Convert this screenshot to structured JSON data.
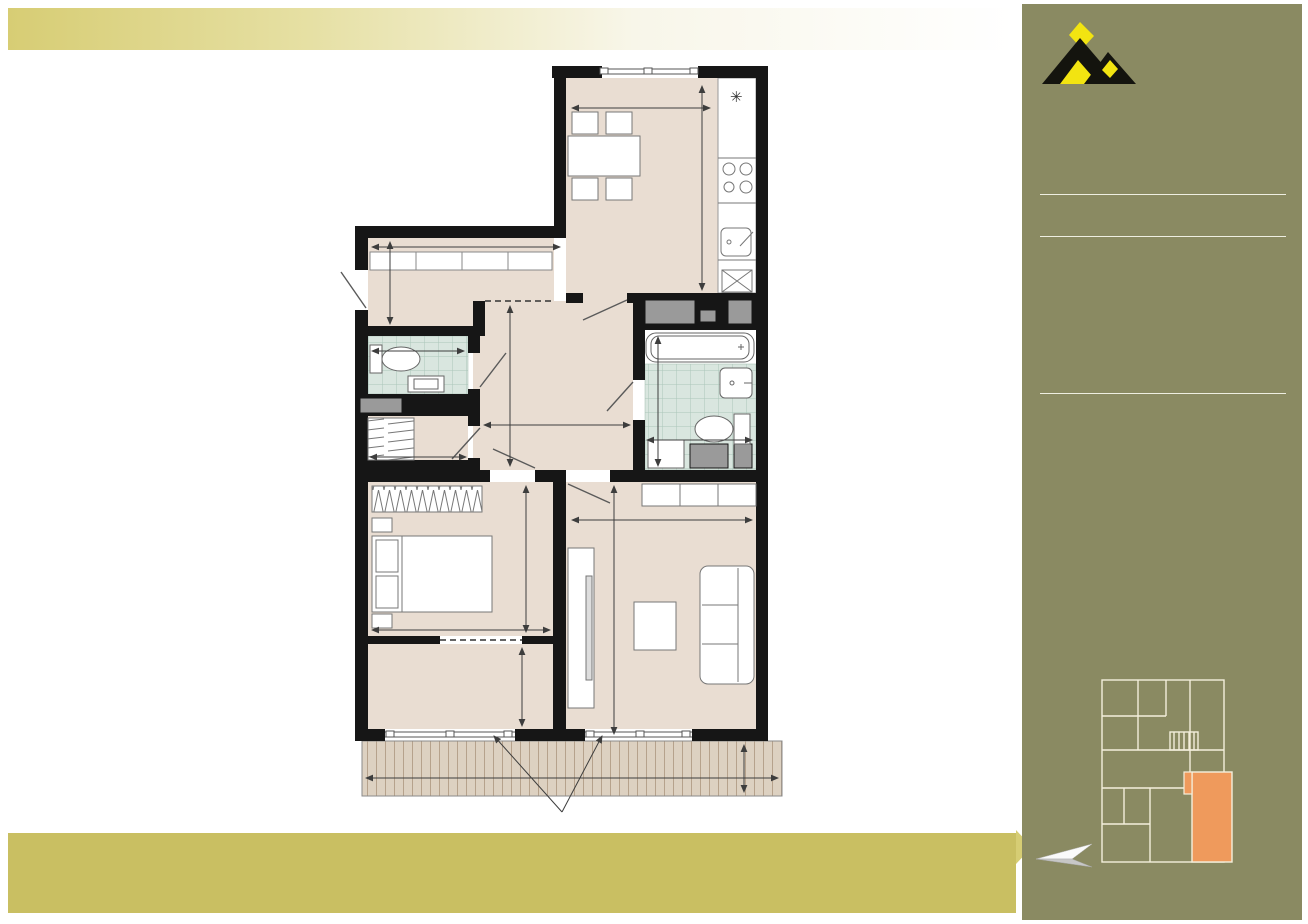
{
  "header": {
    "title": "ПЛАН  КВАРТИРИ",
    "building": "будинок 1Д"
  },
  "sidebar": {
    "brand": "ЖК СОФІТ",
    "apartment_type": "Двокімнатна",
    "total_area_label": "Загальна площа",
    "total_area_label_line1": "Загальна",
    "total_area_label_line2": "площа",
    "total_area_value": "69,76",
    "schema_title": "Схема розташування квартири",
    "street_right": "вул.Мікльоша К.",
    "street_bottom": "вул.Стрийська",
    "colors": {
      "sidebar_bg": "#8a8a62",
      "highlight_apartment": "#ef9a5c",
      "text_cream": "#f5efda"
    }
  },
  "plan": {
    "terrace_note": "Сходинка підйому на терасу",
    "washing_machine": "пм",
    "colors": {
      "wall": "#161616",
      "floor": "#e9ddd2",
      "tile": "#d9e6df",
      "deck": "#ddd1c1"
    },
    "rooms": {
      "kitchen_dining": "13,82",
      "hallway": "5,09",
      "wc": "1,94",
      "hall": "8,93",
      "bathroom": "4,64",
      "closet": "2,17",
      "bedroom": "10,54",
      "living_room": "15,94",
      "back_room": "4,86",
      "terrace": "6,10",
      "terrace_reduced": "1,83"
    },
    "dimensions_mm": {
      "kitchen_width": "3030",
      "kitchen_depth": "4560",
      "hallway_width": "3060",
      "hallway_depth": "1870",
      "wc_width": "1640",
      "hall_height": "3530",
      "hall_width": "2530",
      "bath_height": "2960",
      "bath_width": "1780",
      "closet_width": "1640",
      "bedroom_height": "3510",
      "bedroom_width": "3060",
      "living_width": "3030",
      "living_height": "5260",
      "back_room_height": "1610",
      "terrace_width": "6425",
      "terrace_depth": "950"
    }
  },
  "footer": {
    "lines": [
      "Усі вказані розміри - метричні. Площі та габаритні розміри приміщень визначені відстанню між  поверхнями стін,",
      "інші розміри проставлені між конструктивними елементами без фінішного оздоблення.",
      "Усі матеріали, розміри та креслення є лише приблизними. Інформація може бути змінена без попередження.",
      "Фактична площа може відрізнятися від вказаної, креслення зображені не в масштабі."
    ]
  }
}
